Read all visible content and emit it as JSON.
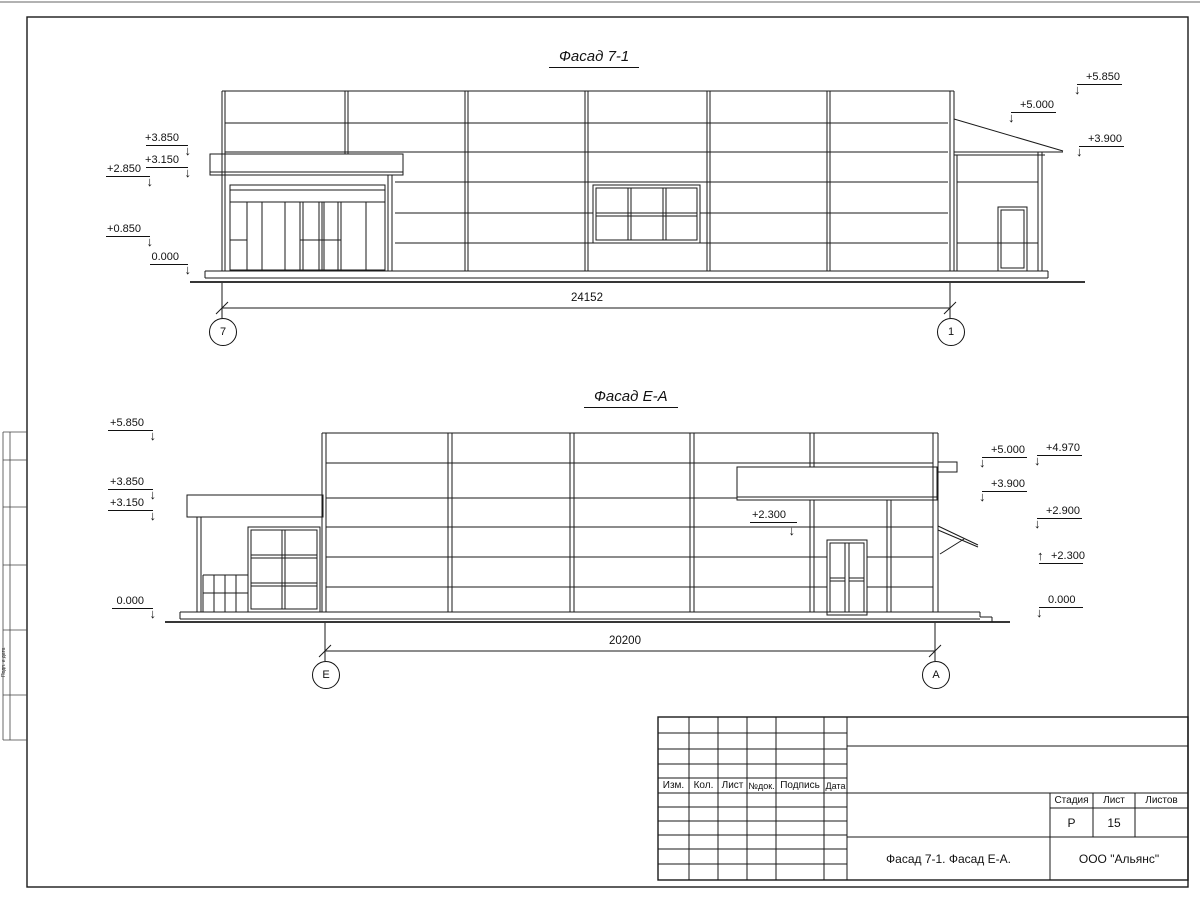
{
  "facade1": {
    "title": "Фасад 7-1",
    "dim": "24152",
    "axis_left": "7",
    "axis_right": "1",
    "marks_left": [
      "+3.850",
      "+3.150",
      "+2.850",
      "+0.850",
      "0.000"
    ],
    "marks_right": [
      "+5.850",
      "+5.000",
      "+3.900"
    ]
  },
  "facade2": {
    "title": "Фасад Е-А",
    "dim": "20200",
    "axis_left": "Е",
    "axis_right": "А",
    "marks_left": [
      "+5.850",
      "+3.850",
      "+3.150",
      "0.000"
    ],
    "marks_right": [
      "+5.000",
      "+4.970",
      "+3.900",
      "+2.900",
      "+2.300",
      "0.000"
    ],
    "mark_inner": "+2.300"
  },
  "title_block": {
    "revision_cols": [
      "Изм.",
      "Кол.",
      "Лист",
      "№док.",
      "Подпись",
      "Дата"
    ],
    "stage_label": "Стадия",
    "sheet_label": "Лист",
    "sheets_label": "Листов",
    "stage_value": "Р",
    "sheet_value": "15",
    "sheets_value": "",
    "doc_title": "Фасад 7-1. Фасад Е-А.",
    "company": "ООО \"Альянс\""
  },
  "side_strip": {
    "label": "Подп. и дата"
  }
}
